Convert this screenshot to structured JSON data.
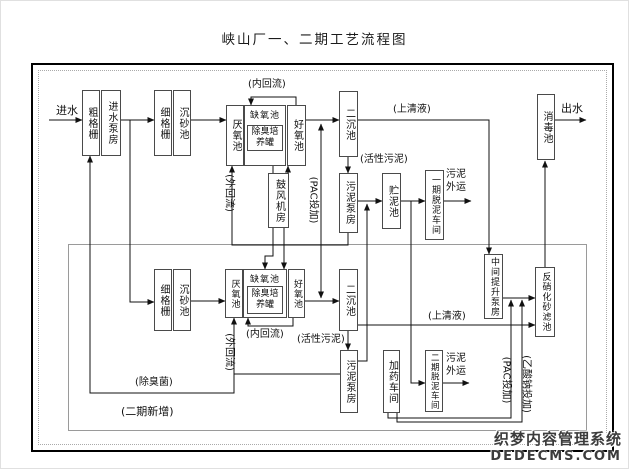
{
  "title": "峡山厂一、二期工艺流程图",
  "watermark": {
    "line1": "织梦内容管理系统",
    "line2": "DEDECMS.COM"
  },
  "colors": {
    "line": "#111",
    "box_border": "#4a4a4a",
    "phase2_border": "#9a9a9a"
  },
  "nodes": [
    {
      "id": "coarse-screen-1",
      "label": "粗格栅",
      "x": 81,
      "y": 89,
      "w": 18,
      "h": 66,
      "type": "v"
    },
    {
      "id": "inlet-pump-house",
      "label": "进水泵房",
      "x": 100,
      "y": 89,
      "w": 20,
      "h": 66,
      "type": "v"
    },
    {
      "id": "fine-screen-1",
      "label": "细格栅",
      "x": 153,
      "y": 89,
      "w": 18,
      "h": 66,
      "type": "v"
    },
    {
      "id": "grit-chamber-1",
      "label": "沉砂池",
      "x": 172,
      "y": 89,
      "w": 18,
      "h": 66,
      "type": "v"
    },
    {
      "id": "anaerobic-tank-1",
      "label": "厌氧池",
      "x": 225,
      "y": 104,
      "w": 18,
      "h": 61,
      "type": "v"
    },
    {
      "id": "anoxic-tank-1",
      "label": "缺氧池",
      "x": 243,
      "y": 104,
      "w": 42,
      "h": 61,
      "type": "group"
    },
    {
      "id": "odor-culture-tank-1",
      "label": "除臭培\n养罐",
      "x": 246,
      "y": 124,
      "w": 36,
      "h": 26,
      "type": "h"
    },
    {
      "id": "aerobic-tank-1",
      "label": "好氧池",
      "x": 286,
      "y": 104,
      "w": 19,
      "h": 61,
      "type": "v"
    },
    {
      "id": "secondary-clarifier-1",
      "label": "二沉池",
      "x": 338,
      "y": 90,
      "w": 19,
      "h": 66,
      "type": "v"
    },
    {
      "id": "blower-room",
      "label": "鼓风机房",
      "x": 267,
      "y": 172,
      "w": 21,
      "h": 55,
      "type": "v"
    },
    {
      "id": "sludge-pump-house-1",
      "label": "污泥泵房",
      "x": 338,
      "y": 172,
      "w": 19,
      "h": 60,
      "type": "v"
    },
    {
      "id": "sludge-storage-tank",
      "label": "贮泥池",
      "x": 381,
      "y": 172,
      "w": 19,
      "h": 56,
      "type": "v"
    },
    {
      "id": "phase1-dewatering",
      "label": "一期脱泥车间",
      "x": 424,
      "y": 169,
      "w": 19,
      "h": 70,
      "type": "v",
      "fs": 9
    },
    {
      "id": "disinfection-tank",
      "label": "消毒池",
      "x": 536,
      "y": 93,
      "w": 18,
      "h": 66,
      "type": "v"
    },
    {
      "id": "intermediate-lift-pump",
      "label": "中间提升泵房",
      "x": 483,
      "y": 253,
      "w": 19,
      "h": 65,
      "type": "v",
      "fs": 9
    },
    {
      "id": "denitrification-filter",
      "label": "反硝化砂滤池",
      "x": 534,
      "y": 266,
      "w": 20,
      "h": 70,
      "type": "v",
      "fs": 9
    },
    {
      "id": "fine-screen-2",
      "label": "细格栅",
      "x": 153,
      "y": 268,
      "w": 18,
      "h": 62,
      "type": "v"
    },
    {
      "id": "grit-chamber-2",
      "label": "沉砂池",
      "x": 172,
      "y": 268,
      "w": 18,
      "h": 62,
      "type": "v"
    },
    {
      "id": "anaerobic-tank-2",
      "label": "厌氧池",
      "x": 224,
      "y": 268,
      "w": 18,
      "h": 49,
      "type": "v",
      "fs": 9
    },
    {
      "id": "anoxic-tank-2",
      "label": "缺氧池",
      "x": 242,
      "y": 268,
      "w": 44,
      "h": 49,
      "type": "group"
    },
    {
      "id": "odor-culture-tank-2",
      "label": "除臭培\n养罐",
      "x": 246,
      "y": 285,
      "w": 36,
      "h": 28,
      "type": "h"
    },
    {
      "id": "aerobic-tank-2",
      "label": "好氧池",
      "x": 287,
      "y": 268,
      "w": 17,
      "h": 49,
      "type": "v",
      "fs": 9
    },
    {
      "id": "secondary-clarifier-2",
      "label": "二沉池",
      "x": 338,
      "y": 268,
      "w": 19,
      "h": 62,
      "type": "v"
    },
    {
      "id": "sludge-pump-house-2",
      "label": "污泥泵房",
      "x": 339,
      "y": 349,
      "w": 18,
      "h": 63,
      "type": "v"
    },
    {
      "id": "dosing-workshop",
      "label": "加药车间",
      "x": 382,
      "y": 349,
      "w": 17,
      "h": 63,
      "type": "v"
    },
    {
      "id": "phase2-dewatering",
      "label": "二期脱泥车间",
      "x": 424,
      "y": 349,
      "w": 18,
      "h": 62,
      "type": "v",
      "fs": 8.5
    }
  ],
  "labels": [
    {
      "id": "influent",
      "text": "进水",
      "x": 55,
      "y": 103,
      "fs": 11
    },
    {
      "id": "effluent",
      "text": "出水",
      "x": 560,
      "y": 101,
      "fs": 11
    },
    {
      "id": "internal-recycle-1",
      "text": "(内回流)",
      "x": 247,
      "y": 78
    },
    {
      "id": "supernatant-1",
      "text": "(上清液)",
      "x": 392,
      "y": 103
    },
    {
      "id": "activated-sludge-1",
      "text": "(活性污泥)",
      "x": 359,
      "y": 153
    },
    {
      "id": "sludge-out-1",
      "text": "污泥\n外运",
      "x": 445,
      "y": 168
    },
    {
      "id": "internal-recycle-2",
      "text": "(内回流)",
      "x": 245,
      "y": 328
    },
    {
      "id": "activated-sludge-2",
      "text": "(活性污泥)",
      "x": 296,
      "y": 333
    },
    {
      "id": "supernatant-2",
      "text": "(上清液)",
      "x": 427,
      "y": 310
    },
    {
      "id": "sludge-out-2",
      "text": "污泥\n外运",
      "x": 445,
      "y": 352
    },
    {
      "id": "deodorant-bacteria",
      "text": "(除臭菌)",
      "x": 134,
      "y": 376
    },
    {
      "id": "phase2-new",
      "text": "(二期新增)",
      "x": 120,
      "y": 404,
      "fs": 11
    },
    {
      "id": "external-recycle-1",
      "text": "(外回流)",
      "cx": 227,
      "cy": 192,
      "rot": true
    },
    {
      "id": "pac-dosing-1",
      "text": "(PAC投加)",
      "cx": 311,
      "cy": 199,
      "rot": true
    },
    {
      "id": "external-recycle-2",
      "text": "(外回流)",
      "cx": 227,
      "cy": 351,
      "rot": true
    },
    {
      "id": "pac-dosing-2",
      "text": "(PAC投加)",
      "cx": 504,
      "cy": 379,
      "rot": true
    },
    {
      "id": "sodium-acetate-dosing",
      "text": "(乙酸钠投加)",
      "cx": 524,
      "cy": 383,
      "rot": true
    }
  ],
  "edges": [
    {
      "id": "influent-arrow",
      "points": [
        [
          48,
          119
        ],
        [
          81,
          119
        ]
      ]
    },
    {
      "id": "pump-to-fine-screen",
      "points": [
        [
          120,
          119
        ],
        [
          153,
          119
        ]
      ]
    },
    {
      "id": "grit-to-anaerobic-1",
      "points": [
        [
          190,
          119
        ],
        [
          225,
          119
        ]
      ]
    },
    {
      "id": "aerobic1-to-clarifier1",
      "points": [
        [
          305,
          119
        ],
        [
          338,
          119
        ]
      ]
    },
    {
      "id": "supernatant1-to-lift-pump",
      "points": [
        [
          357,
          119
        ],
        [
          488,
          119
        ],
        [
          488,
          253
        ]
      ]
    },
    {
      "id": "effluent-arrow",
      "points": [
        [
          554,
          119
        ],
        [
          585,
          119
        ]
      ]
    },
    {
      "id": "internal-recycle-1",
      "points": [
        [
          295,
          104
        ],
        [
          295,
          96
        ],
        [
          250,
          96
        ],
        [
          250,
          104
        ]
      ]
    },
    {
      "id": "blower-to-odor-tank-1",
      "points": [
        [
          272,
          172
        ],
        [
          272,
          151
        ]
      ]
    },
    {
      "id": "blower-to-aerobic-1",
      "points": [
        [
          287,
          172
        ],
        [
          287,
          165
        ]
      ]
    },
    {
      "id": "blower-to-odor-tank-2",
      "points": [
        [
          272,
          227
        ],
        [
          272,
          255
        ],
        [
          264,
          255
        ],
        [
          264,
          268
        ]
      ]
    },
    {
      "id": "blower-to-aerobic-2",
      "points": [
        [
          283,
          227
        ],
        [
          283,
          268
        ]
      ]
    },
    {
      "id": "pac-line-up",
      "points": [
        [
          320,
          200
        ],
        [
          320,
          123
        ]
      ]
    },
    {
      "id": "pac-line-down",
      "points": [
        [
          320,
          200
        ],
        [
          320,
          297
        ]
      ]
    },
    {
      "id": "clarifier1-to-sludge-pump1",
      "points": [
        [
          347,
          156
        ],
        [
          347,
          172
        ]
      ]
    },
    {
      "id": "sludge-pump1-to-storage",
      "points": [
        [
          357,
          200
        ],
        [
          381,
          200
        ]
      ]
    },
    {
      "id": "storage-to-phase1-dewatering",
      "points": [
        [
          400,
          200
        ],
        [
          424,
          200
        ]
      ]
    },
    {
      "id": "phase1-sludge-out",
      "points": [
        [
          443,
          200
        ],
        [
          470,
          200
        ]
      ]
    },
    {
      "id": "storage-to-phase2-dewatering",
      "points": [
        [
          410,
          200
        ],
        [
          410,
          382
        ],
        [
          424,
          382
        ]
      ]
    },
    {
      "id": "phase2-sludge-out",
      "points": [
        [
          442,
          382
        ],
        [
          468,
          382
        ]
      ]
    },
    {
      "id": "sludge-pump2-up-to-storage",
      "points": [
        [
          357,
          360
        ],
        [
          366,
          360
        ],
        [
          366,
          203
        ]
      ]
    },
    {
      "id": "external-recycle-1",
      "points": [
        [
          347,
          232
        ],
        [
          347,
          244
        ],
        [
          231,
          244
        ],
        [
          231,
          165
        ]
      ]
    },
    {
      "id": "pump-down-to-fine-screen-2",
      "points": [
        [
          129,
          119
        ],
        [
          129,
          301
        ],
        [
          153,
          301
        ]
      ]
    },
    {
      "id": "grit2-to-anaerobic-2",
      "points": [
        [
          190,
          300
        ],
        [
          224,
          300
        ]
      ]
    },
    {
      "id": "aerobic2-to-clarifier2",
      "points": [
        [
          304,
          300
        ],
        [
          338,
          300
        ]
      ]
    },
    {
      "id": "internal-recycle-2",
      "points": [
        [
          292,
          317
        ],
        [
          292,
          325
        ],
        [
          247,
          325
        ],
        [
          247,
          317
        ]
      ]
    },
    {
      "id": "external-recycle-2",
      "points": [
        [
          339,
          373
        ],
        [
          233,
          373
        ],
        [
          233,
          317
        ]
      ]
    },
    {
      "id": "deodorant-line",
      "points": [
        [
          233,
          373
        ],
        [
          233,
          392
        ],
        [
          89,
          392
        ],
        [
          89,
          155
        ]
      ]
    },
    {
      "id": "clarifier2-to-sludge-pump2",
      "points": [
        [
          347,
          330
        ],
        [
          347,
          349
        ]
      ]
    },
    {
      "id": "supernatant2-to-filter",
      "points": [
        [
          357,
          324
        ],
        [
          534,
          324
        ]
      ]
    },
    {
      "id": "lift-pump-to-filter",
      "points": [
        [
          502,
          297
        ],
        [
          534,
          297
        ]
      ]
    },
    {
      "id": "filter-to-disinfection",
      "points": [
        [
          544,
          266
        ],
        [
          544,
          160
        ]
      ]
    },
    {
      "id": "dosing-pac-line",
      "points": [
        [
          387,
          412
        ],
        [
          387,
          417
        ],
        [
          510,
          417
        ],
        [
          510,
          299
        ]
      ]
    },
    {
      "id": "dosing-acetate-line",
      "points": [
        [
          396,
          412
        ],
        [
          396,
          421
        ],
        [
          521,
          421
        ],
        [
          521,
          299
        ]
      ]
    }
  ]
}
